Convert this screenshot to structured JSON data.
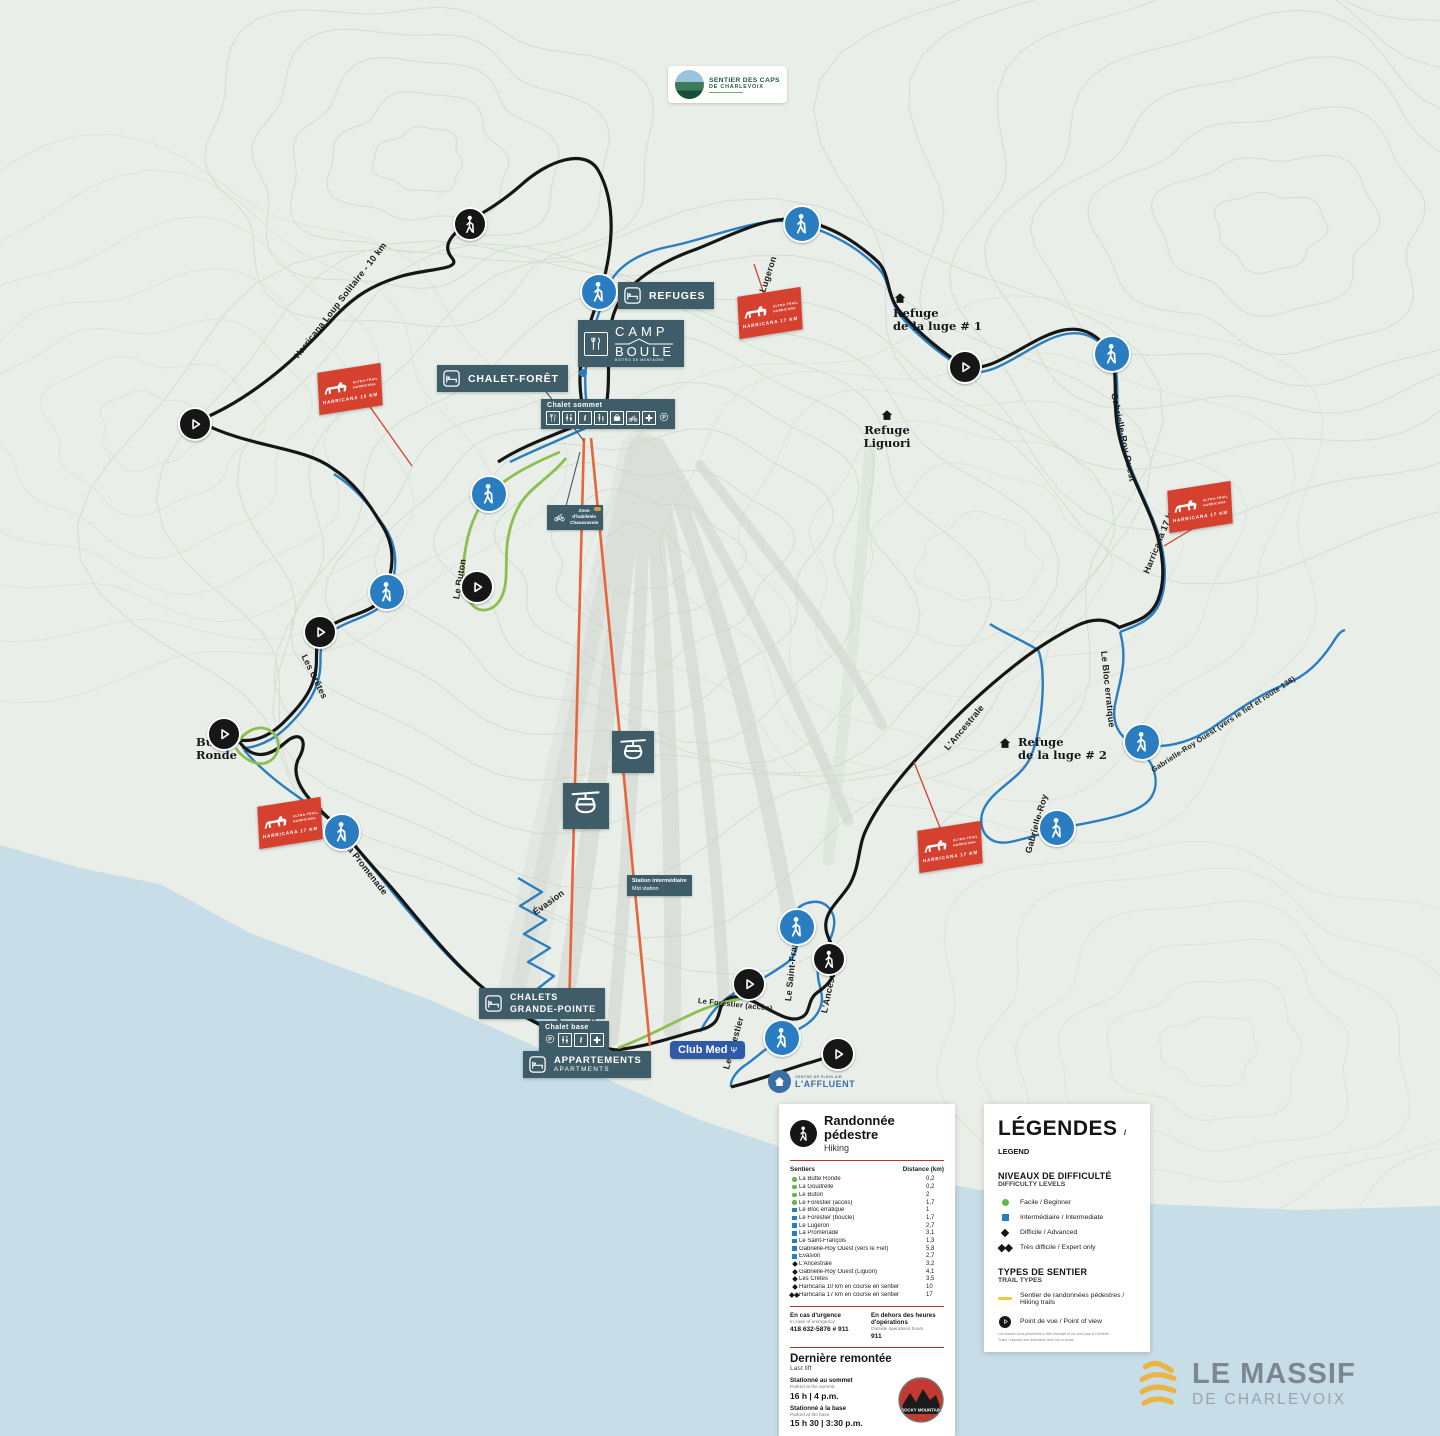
{
  "map": {
    "region_logos": {
      "sentier_des_caps_l1": "SENTIER DES CAPS",
      "sentier_des_caps_l2": "DE CHARLEVOIX",
      "club_med": "Club Med",
      "club_med_glyph": "Ψ",
      "affluent_l1": "CENTRE DE PLEIN AIR",
      "affluent_l2": "L'AFFLUENT",
      "le_massif_l1": "LE MASSIF",
      "le_massif_l2": "DE CHARLEVOIX",
      "rocky_mountain": "ROCKY MOUNTAIN"
    },
    "facilities": {
      "refuges": "REFUGES",
      "camp_boule_l1": "CAMP",
      "camp_boule_l2": "BOULE",
      "camp_boule_sub": "BISTRO DE MONTAGNE",
      "chalet_foret": "CHALET-FORÊT",
      "chalet_sommet": "Chalet sommet",
      "chalet_base": "Chalet base",
      "chalets_grande_pointe_l1": "CHALETS",
      "chalets_grande_pointe_l2": "GRANDE-POINTE",
      "appartements": "APPARTEMENTS",
      "apartments": "APARTMENTS",
      "station_intermediaire_l1": "Station intermédiaire",
      "station_intermediaire_l2": "Mid station",
      "zone_habiletes_l1": "Zone",
      "zone_habiletes_l2": "d'habiletés",
      "zone_habiletes_l3": "Chaussavoie"
    },
    "poi": {
      "refuge_luge1_l1": "Refuge",
      "refuge_luge1_l2": "de la luge # 1",
      "refuge_liguori_l1": "Refuge",
      "refuge_liguori_l2": "Liguori",
      "refuge_luge2_l1": "Refuge",
      "refuge_luge2_l2": "de la luge # 2",
      "butte_ronde_l1": "Butte",
      "butte_ronde_l2": "Ronde"
    },
    "trail_labels": {
      "harricana_loup": "Harricana Loup Solitaire - 10 km",
      "lugeron": "Le Lugeron",
      "gabrielle_roy_ouest": "Gabrielle-Roy Ouest",
      "harricana_17": "Harricana 17 km",
      "buton": "Le Buton",
      "cretes": "Les Crêtes",
      "promenade": "La Promenade",
      "evasion": "Évasion",
      "goudrelle": "La Goudrelle",
      "forestier_acces": "Le Forestier (accès)",
      "forestier": "Le Forestier",
      "saint_francois": "Le Saint-François",
      "ancestrale": "L'Ancestrale",
      "ancestrale2": "L'Ancestrale",
      "bloc_erratique": "Le Bloc erratique",
      "gabrielle_roy": "Gabrielle-Roy",
      "gr_ouest_fief": "Gabrielle-Roy Ouest (vers le fief et route 138)"
    },
    "flags": {
      "brand_l1": "ULTRA-TRAIL",
      "brand_l2": "HARRICANA",
      "f1": "HARRICANA 10 KM",
      "f2": "HARRICANA 17 KM",
      "f3": "HARRICANA 17 KM",
      "f4": "HARRICANA 17 KM",
      "f5": "HARRICANA 17 KM"
    },
    "colors": {
      "beginner": "#64b54a",
      "intermediate": "#2a7dc0",
      "advanced": "#161616",
      "lift_line": "#e8653a",
      "event_flag": "#d6402f",
      "hiking_trail_legend": "#f0c93d",
      "water": "#c7dde7",
      "label_box": "#3f5d68"
    }
  },
  "hiking_panel": {
    "title": "Randonnée pédestre",
    "subtitle": "Hiking",
    "col_trails": "Sentiers",
    "col_distance": "Distance (km)",
    "trails": [
      {
        "name": "La Butte Ronde",
        "distance": "0,2",
        "level": "beginner"
      },
      {
        "name": "La Goudrelle",
        "distance": "0,2",
        "level": "beginner"
      },
      {
        "name": "Le Buton",
        "distance": "2",
        "level": "beginner"
      },
      {
        "name": "Le Forestier (accès)",
        "distance": "1,7",
        "level": "beginner"
      },
      {
        "name": "Le Bloc erratique",
        "distance": "1",
        "level": "intermediate"
      },
      {
        "name": "Le Forestier (boucle)",
        "distance": "1,7",
        "level": "intermediate"
      },
      {
        "name": "Le Lugeron",
        "distance": "2,7",
        "level": "intermediate"
      },
      {
        "name": "La Promenade",
        "distance": "3,1",
        "level": "intermediate"
      },
      {
        "name": "Le Saint-François",
        "distance": "1,3",
        "level": "intermediate"
      },
      {
        "name": "Gabrielle-Roy Ouest (vers le Fief)",
        "distance": "5,8",
        "level": "intermediate"
      },
      {
        "name": "Évasion",
        "distance": "2,7",
        "level": "intermediate"
      },
      {
        "name": "L'Ancestrale",
        "distance": "3,2",
        "level": "advanced"
      },
      {
        "name": "Gabrielle-Roy Ouest (Liguori)",
        "distance": "4,1",
        "level": "advanced"
      },
      {
        "name": "Les Crêtes",
        "distance": "3,5",
        "level": "advanced"
      },
      {
        "name": "Harricana 10 km en course en sentier",
        "distance": "10",
        "level": "advanced"
      },
      {
        "name": "Harricana 17 km en course en sentier",
        "distance": "17",
        "level": "expert"
      }
    ],
    "emergency": {
      "fr": "En cas d'urgence",
      "en": "In case of emergency",
      "phone": "418 632-5876 # 911",
      "after_fr": "En dehors des heures d'opérations",
      "after_en": "Outside operations hours",
      "after_phone": "911"
    },
    "last_lift": {
      "fr": "Dernière remontée",
      "en": "Last lift",
      "summit_fr": "Stationné au sommet",
      "summit_en": "Parked at the summit",
      "summit_time": "16 h | 4 p.m.",
      "base_fr": "Stationné à la base",
      "base_en": "Parked at the base",
      "base_time": "15 h 30 | 3:30 p.m."
    }
  },
  "legend_panel": {
    "title": "LÉGENDES",
    "title_suffix": "/ LEGEND",
    "difficulty_title": "NIVEAUX DE DIFFICULTÉ",
    "difficulty_subtitle": "DIFFICULTY LEVELS",
    "levels": [
      {
        "label": "Facile / Beginner"
      },
      {
        "label": "Intermédiaire / Intermediate"
      },
      {
        "label": "Difficile / Advanced"
      },
      {
        "label": "Très difficile / Expert only"
      }
    ],
    "types_title": "TYPES DE SENTIER",
    "types_subtitle": "TRAIL TYPES",
    "type_hiking": "Sentier de randonnées pédestres / Hiking trails",
    "type_viewpoint": "Point de vue / Point of view",
    "disclaimer_l1": "Les tracés sont présentés à titre indicatif et ne sont pas à l'échelle.",
    "disclaimer_l2": "Trails / layouts are indicative and not to scale."
  }
}
